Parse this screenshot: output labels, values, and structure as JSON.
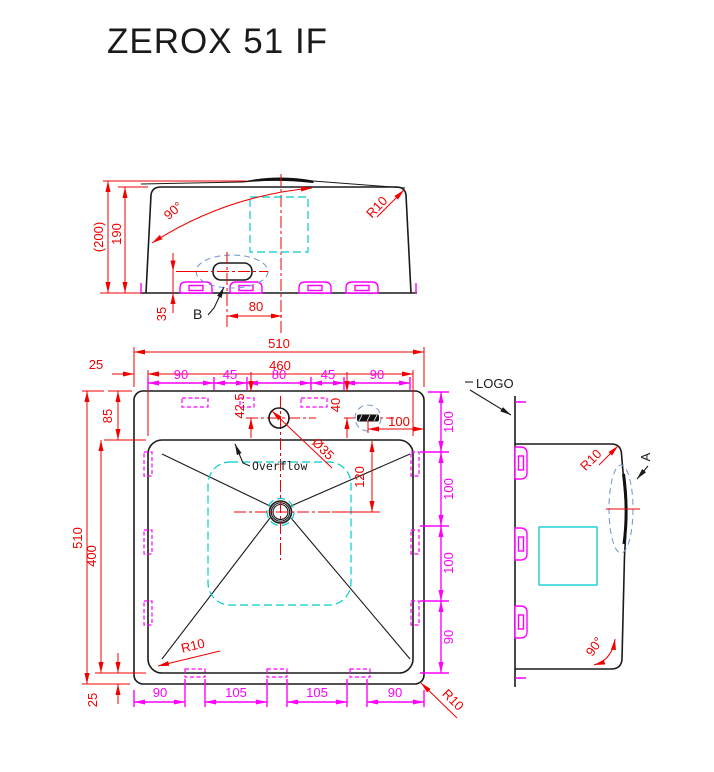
{
  "title": "ZEROX 51 IF",
  "colors": {
    "dimension_red": "#f10000",
    "clip_magenta": "#ff00ff",
    "template_cyan": "#00cbcb",
    "detail_blue": "#7b9cd1",
    "outline_black": "#1a1a1a"
  },
  "front_view": {
    "dim_overall_height": "(200)",
    "dim_body_height": "190",
    "angle_label": "90°",
    "radius_label": "R10",
    "dim_slot_bottom": "35",
    "dim_slot_offset": "80",
    "detail_label": "B"
  },
  "plan_view": {
    "dim_overall_width": "510",
    "dim_inner_width": "460",
    "dim_left_margin": "25",
    "top_chain": [
      "90",
      "45",
      "80",
      "45",
      "90"
    ],
    "dim_top_margin": "85",
    "dim_overall_height": "510",
    "dim_bowl_depth": "400",
    "dim_bottom_margin": "25",
    "dim_faucet_down": "42.5",
    "dim_overflow_down": "40",
    "dim_overflow_right": "100",
    "faucet_diameter": "Ø35",
    "dim_drain_down": "120",
    "overflow_label": "Overflow",
    "right_chain": [
      "100",
      "100",
      "100",
      "90"
    ],
    "bottom_chain": [
      "90",
      "105",
      "105",
      "90"
    ],
    "inner_radius_label": "R10",
    "outer_radius_label": "R10"
  },
  "side_view": {
    "logo_label": "LOGO",
    "radius_label": "R10",
    "detail_label": "A",
    "angle_label": "90°"
  }
}
